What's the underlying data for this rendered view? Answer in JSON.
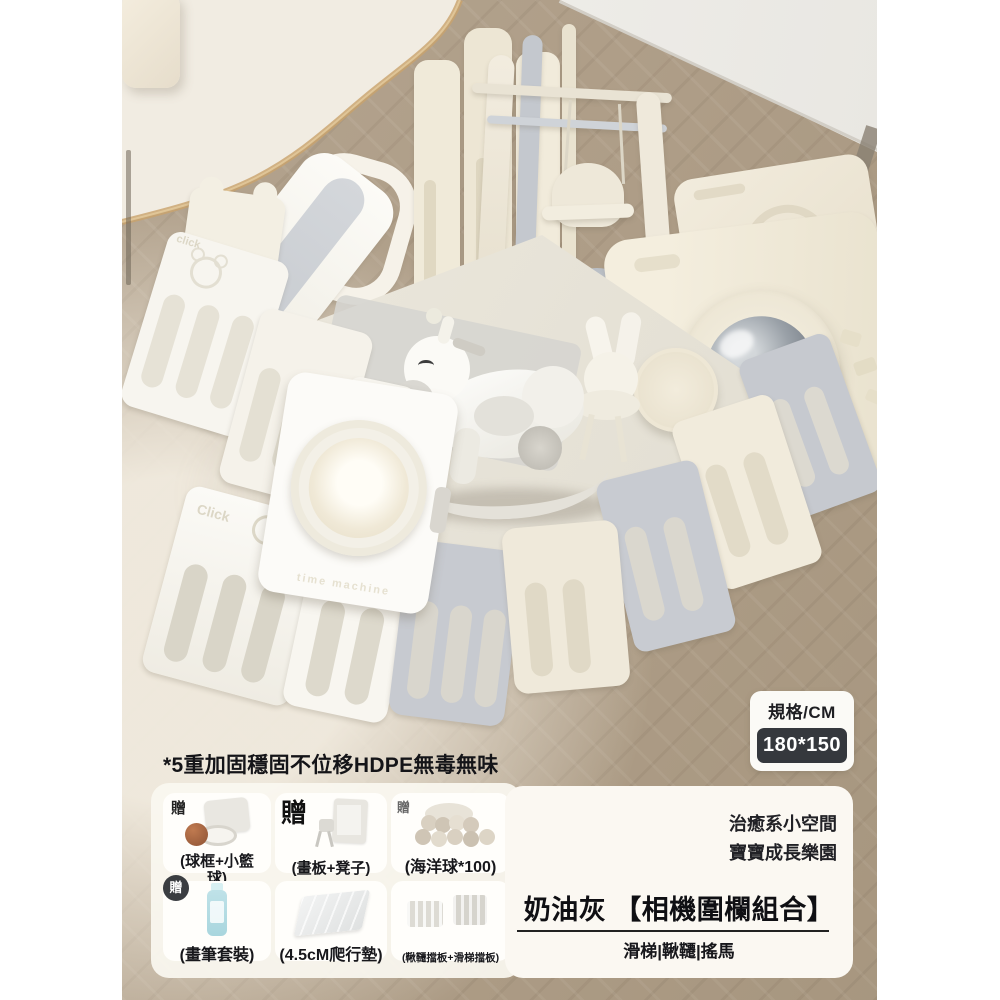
{
  "spec_badge": {
    "label": "規格/CM",
    "value": "180*150"
  },
  "claim_text": "*5重加固穩固不位移HDPE無毒無味",
  "gifts": {
    "badge_label": "贈",
    "items": [
      {
        "caption": "(球框+小籃球)",
        "icon": "basketball-hoop"
      },
      {
        "caption": "(畫板+凳子)",
        "icon": "easel-stool"
      },
      {
        "caption": "(海洋球*100)",
        "icon": "ocean-balls"
      },
      {
        "caption": "(畫筆套裝)",
        "icon": "paint-pen-set"
      },
      {
        "caption": "(4.5cM爬行墊)",
        "icon": "crawl-mat"
      },
      {
        "caption": "(鞦韆擋板+滑梯擋板)",
        "icon": "guard-boards"
      }
    ]
  },
  "promo": {
    "slogan_line1": "治癒系小空間",
    "slogan_line2": "寶寶成長樂園",
    "title": "奶油灰 【相機圍欄組合】",
    "subtitle": "滑梯|鞦韆|搖馬"
  },
  "photo": {
    "embossed_click": "Click",
    "embossed_click_small": "click",
    "embossed_door": "time machine",
    "colors": {
      "cream": "#f0ead9",
      "gray": "#c6c9cf",
      "white": "#f8f6f1",
      "gold_trim": "#c9a36b",
      "badge_dark": "#35383d"
    }
  }
}
